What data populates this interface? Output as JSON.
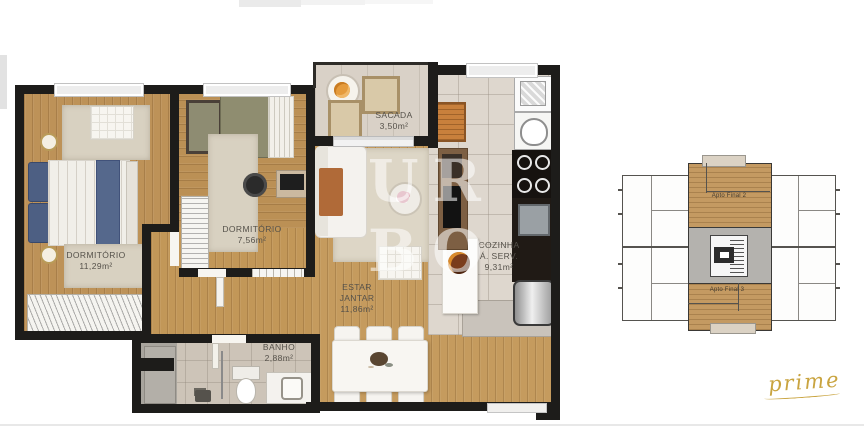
{
  "watermark": {
    "line1": "UR",
    "line2": "BO"
  },
  "brand": {
    "logo": "prime"
  },
  "floorplan": {
    "rooms": [
      {
        "name": "DORMITÓRIO",
        "area": "11,29m²"
      },
      {
        "name": "DORMITÓRIO",
        "area": "7,56m²"
      },
      {
        "name": "SACADA",
        "area": "3,50m²"
      },
      {
        "name": "COZINHA",
        "subname": "Á. SERV.",
        "area": "9,31m²"
      },
      {
        "name": "ESTAR",
        "subname": "JANTAR",
        "area": "11,86m²"
      },
      {
        "name": "BANHO",
        "area": "2,88m²"
      }
    ]
  },
  "keyplan": {
    "unit_top_label": "Apto Final 2",
    "unit_bottom_label": "Apto Final 3"
  },
  "colors": {
    "wall": "#1d1c1a",
    "wood": "#c0955c",
    "tile": "#ded7ce",
    "accent_gold": "#c9a440",
    "bed_blue": "#4d5f83",
    "watermark": "rgba(255,255,255,0.55)"
  }
}
